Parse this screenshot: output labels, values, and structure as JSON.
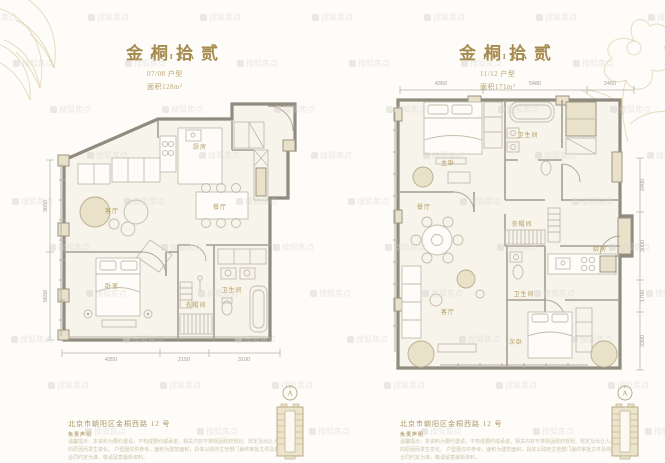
{
  "page": {
    "background": "#fdfcf9",
    "accent_gold": "#a68b4f",
    "watermark_text": "搜狐焦点"
  },
  "left_panel": {
    "title": "金桐拾贰",
    "subtitle": "EPIKA",
    "unit_line": "07/08 户型",
    "area_line": "面积128m²",
    "rooms": {
      "kitchen": "厨房",
      "living": "客厅",
      "dining": "餐厅",
      "bedroom": "卧室",
      "closet": "衣帽间",
      "bath": "卫生间"
    },
    "dims_bottom": [
      "4350",
      "2150",
      "3100"
    ],
    "dims_left": [
      "3650",
      "5650"
    ],
    "footer": {
      "address": "北京市朝阳区金桐西路 12 号",
      "disclaimer_label": "免责声明",
      "disclaimer_line1": "温馨提示：本资料为要约邀请，不构成要约或承诺，相关内容不排除因政府规划、规定及出让人未能控制的原因而发生变化。",
      "disclaimer_line2": "户型图仅供参考，面积为建筑面积，具体以政府主管部门最终审批文件及商品房买卖合同约定为准，敬请留意最新资料。",
      "compass_label": "A"
    }
  },
  "right_panel": {
    "title": "金桐拾贰",
    "subtitle": "EPIKA",
    "unit_line": "11/12 户型",
    "area_line": "面积171m²",
    "rooms": {
      "master": "主卧",
      "bath_top": "卫生间",
      "wardrobe": "衣帽间",
      "dining": "餐厅",
      "living": "客厅",
      "bedroom2": "次卧",
      "kitchen": "厨房",
      "bath_mid": "卫生间"
    },
    "dims_top": [
      "4350",
      "5480",
      "2450"
    ],
    "dims_right": [
      "2400",
      "3000",
      "1700",
      "3300"
    ],
    "footer": {
      "address": "北京市朝阳区金桐西路 12 号",
      "disclaimer_label": "免责声明",
      "disclaimer_line1": "温馨提示：本资料为要约邀请，不构成要约或承诺，相关内容不排除因政府规划、规定及出让人未能控制的原因而发生变化。",
      "disclaimer_line2": "户型图仅供参考，面积为建筑面积，具体以政府主管部门最终审批文件及商品房买卖合同约定为准，敬请留意最新资料。",
      "compass_label": "A"
    }
  }
}
